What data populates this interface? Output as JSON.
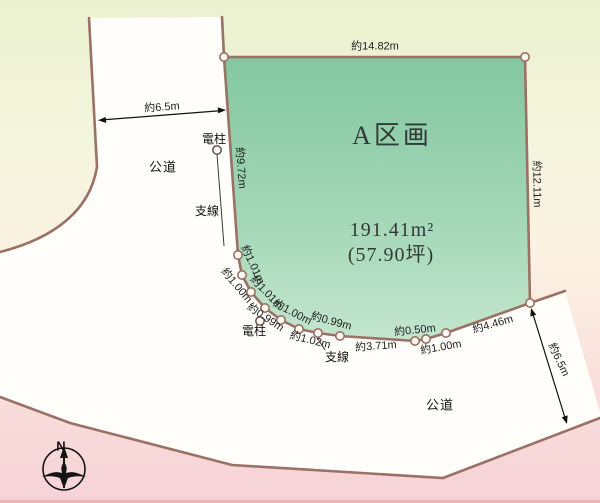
{
  "plot": {
    "name": "A区画",
    "area_sqm": "191.41m²",
    "area_tsubo": "(57.90坪)"
  },
  "dimensions": {
    "top_edge": "約14.82m",
    "right_edge": "約12.11m",
    "left_edge": "約9.72m",
    "road_top_width": "約6.5m",
    "road_right_width": "約6.5m",
    "bottom_segments": [
      "約3.71m",
      "約0.50m",
      "約1.00m",
      "約4.46m"
    ],
    "curve_inner_segments": [
      "約1.01m",
      "約1.01m",
      "約1.00m",
      "約0.99m"
    ],
    "curve_outer_segments": [
      "約1.00m",
      "約0.99m",
      "約1.02m"
    ]
  },
  "features": {
    "road_label_upper": "公道",
    "road_label_lower": "公道",
    "utility_pole_upper": "電柱",
    "utility_pole_lower": "電柱",
    "guy_wire_upper": "支線",
    "guy_wire_lower": "支線"
  },
  "compass": {
    "north_label": "N"
  },
  "colors": {
    "plot_green_top": "#83c7a0",
    "plot_green_bottom": "#c3e6ce",
    "boundary_brown": "#9a7164",
    "road_white": "#fffefa",
    "background_top": "#ebf1d0",
    "background_bottom": "#f6d2d6"
  }
}
